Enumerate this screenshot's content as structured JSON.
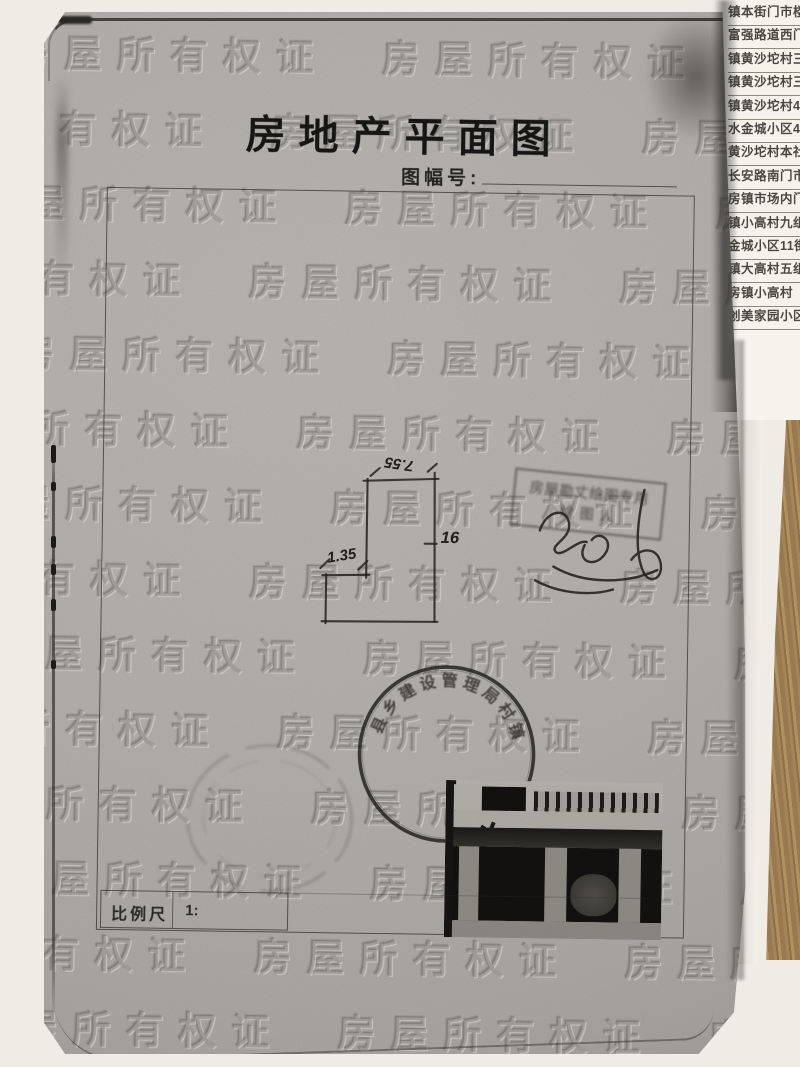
{
  "document": {
    "title": "房地产平面图",
    "sheet_number_label": "图幅号:",
    "scale_label": "比例尺",
    "scale_value": "1:"
  },
  "plan": {
    "dim_top": "7.55",
    "dim_left_step": "1.35",
    "dim_right": "16"
  },
  "stamps": {
    "rect_stamp_row1": "房屋勘丈绘图专用",
    "rect_stamp_row2": "绘 图 人",
    "round_stamp_arc_text": "县乡建设管理局村镇"
  },
  "watermark": {
    "text": "房屋所有权证"
  },
  "side_list": {
    "entries": [
      "镇本街门市楼",
      "富强路道西门市",
      "镇黄沙坨村三组",
      "镇黄沙坨村三组",
      "镇黄沙坨村4组",
      "水金城小区4街",
      "黄沙坨村本社",
      "长安路南门市楼",
      "房镇市场内门",
      "镇小高村九组",
      "金城小区11街",
      "镇大高村五组",
      "房镇小高村",
      "创美家园小区"
    ]
  },
  "colors": {
    "paper_gray": "#b1aea9",
    "ink": "#1f1e1c",
    "stamp_ink": "#2b2a27",
    "wood": "#9a7c52",
    "list_paper": "#f6f3ed"
  }
}
